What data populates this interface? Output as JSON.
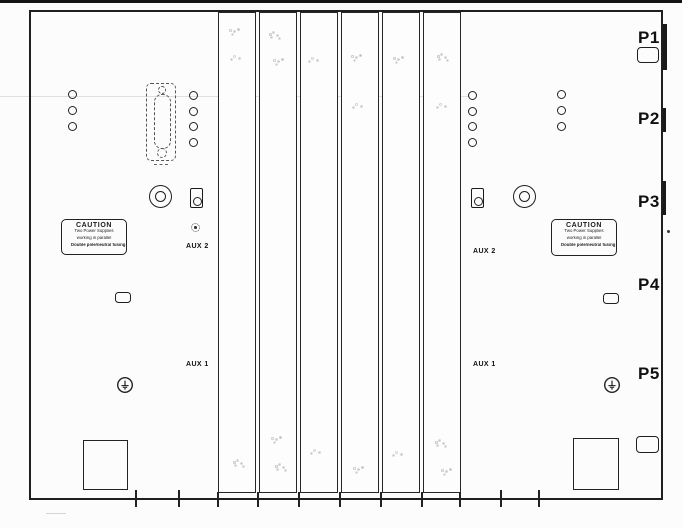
{
  "drawing": {
    "ports": [
      {
        "label": "P1"
      },
      {
        "label": "P2"
      },
      {
        "label": "P3"
      },
      {
        "label": "P4"
      },
      {
        "label": "P5"
      }
    ],
    "aux1_label": "AUX 1",
    "aux2_label": "AUX 2",
    "caution_label": {
      "title": "CAUTION",
      "lines": [
        "Two Power Supplies",
        "working in parallel",
        "Double pole/neutral fusing"
      ]
    },
    "colors": {
      "line": "#1c1c1c",
      "background": "#fcfcfc",
      "scan_edge": "#141414",
      "speckle": "#bdbdbd"
    }
  }
}
